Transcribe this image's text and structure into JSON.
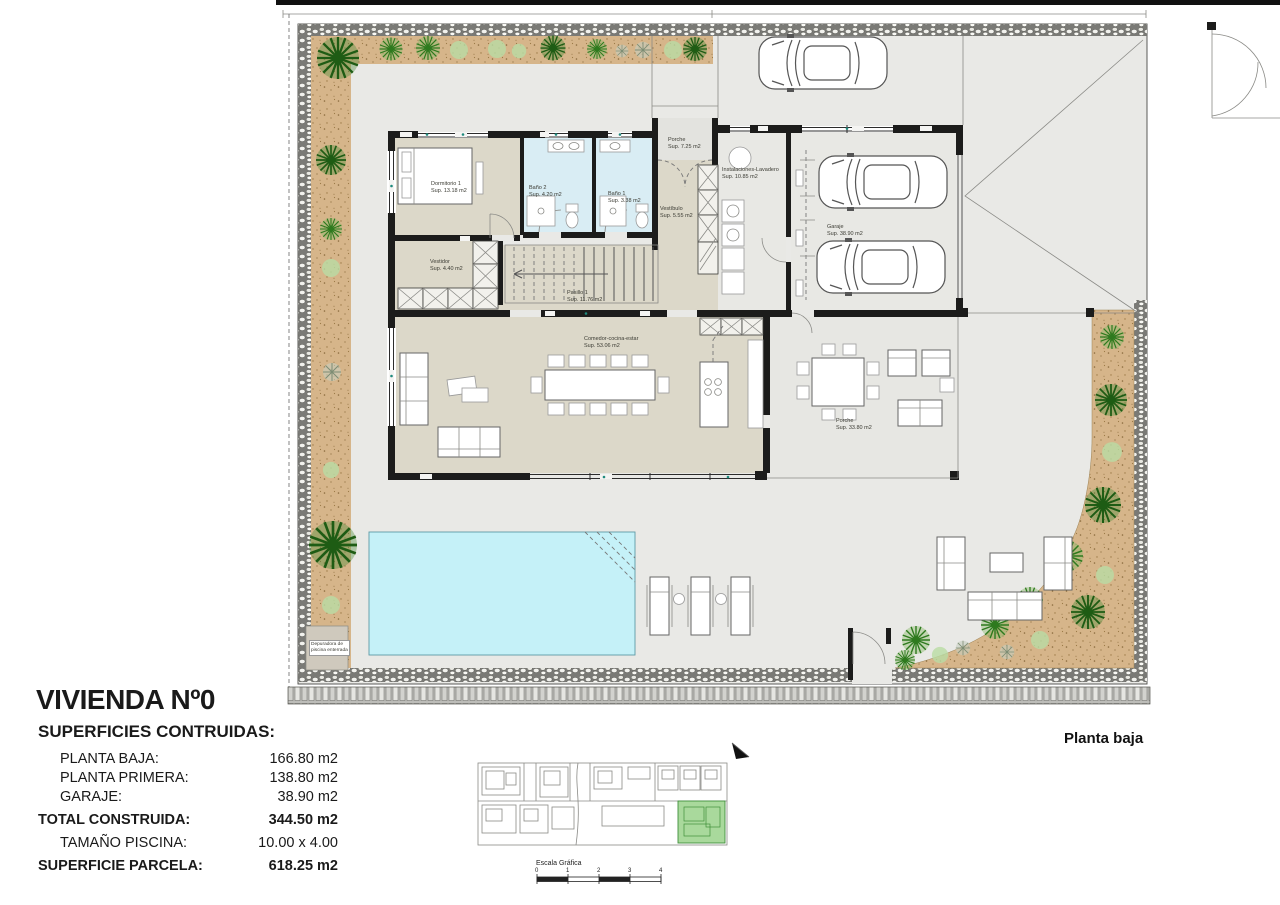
{
  "plan": {
    "sheet_label": "Planta baja",
    "rooms": {
      "dormitorio1": {
        "name": "Dormitorio 1",
        "sup": "Sup. 13.18 m2"
      },
      "bano2": {
        "name": "Baño 2",
        "sup": "Sup. 4.20 m2"
      },
      "bano1": {
        "name": "Baño 1",
        "sup": "Sup. 3.38 m2"
      },
      "porche_entrada": {
        "name": "Porche",
        "sup": "Sup. 7.25 m2"
      },
      "vestibulo": {
        "name": "Vestíbulo",
        "sup": "Sup. 5.55 m2"
      },
      "instalaciones": {
        "name": "Instalaciones-Lavadero",
        "sup": "Sup. 10.85 m2"
      },
      "garaje": {
        "name": "Garaje",
        "sup": "Sup. 38.90 m2"
      },
      "vestidor": {
        "name": "Vestidor",
        "sup": "Sup. 4.40 m2"
      },
      "pasillo1": {
        "name": "Pasillo 1",
        "sup": "Sup. 11.76 m2"
      },
      "comedor": {
        "name": "Comedor-cocina-estar",
        "sup": "Sup. 53.06 m2"
      },
      "porche_terraza": {
        "name": "Porche",
        "sup": "Sup. 33.80 m2"
      }
    },
    "annotations": {
      "depuradora": "Depuradora de piscina enterrada"
    }
  },
  "title_block": {
    "title": "VIVIENDA Nº0",
    "heading": "SUPERFICIES CONTRUIDAS:",
    "rows": [
      {
        "label": "PLANTA BAJA:",
        "value": "166.80 m2"
      },
      {
        "label": "PLANTA PRIMERA:",
        "value": "138.80 m2"
      },
      {
        "label": "GARAJE:",
        "value": "38.90 m2"
      },
      {
        "label": "TOTAL CONSTRUIDA:",
        "value": "344.50 m2"
      },
      {
        "label": "TAMAÑO PISCINA:",
        "value": "10.00 x 4.00"
      },
      {
        "label": "SUPERFICIE PARCELA:",
        "value": "618.25 m2"
      }
    ]
  },
  "key_plan": {
    "scale_label": "Escala Gráfica",
    "ticks": [
      "0",
      "1",
      "2",
      "3",
      "4"
    ]
  },
  "colors": {
    "wall": "#1c1c1b",
    "paving": "#e9e9e6",
    "interior_floor": "#dcd8c9",
    "bath_floor": "#d9edf4",
    "pool_water": "#c5f1f8",
    "garden_soil": "#d6b58a",
    "plant_green": "#2e7a1e",
    "key_plan_highlight": "#a9d99c"
  }
}
